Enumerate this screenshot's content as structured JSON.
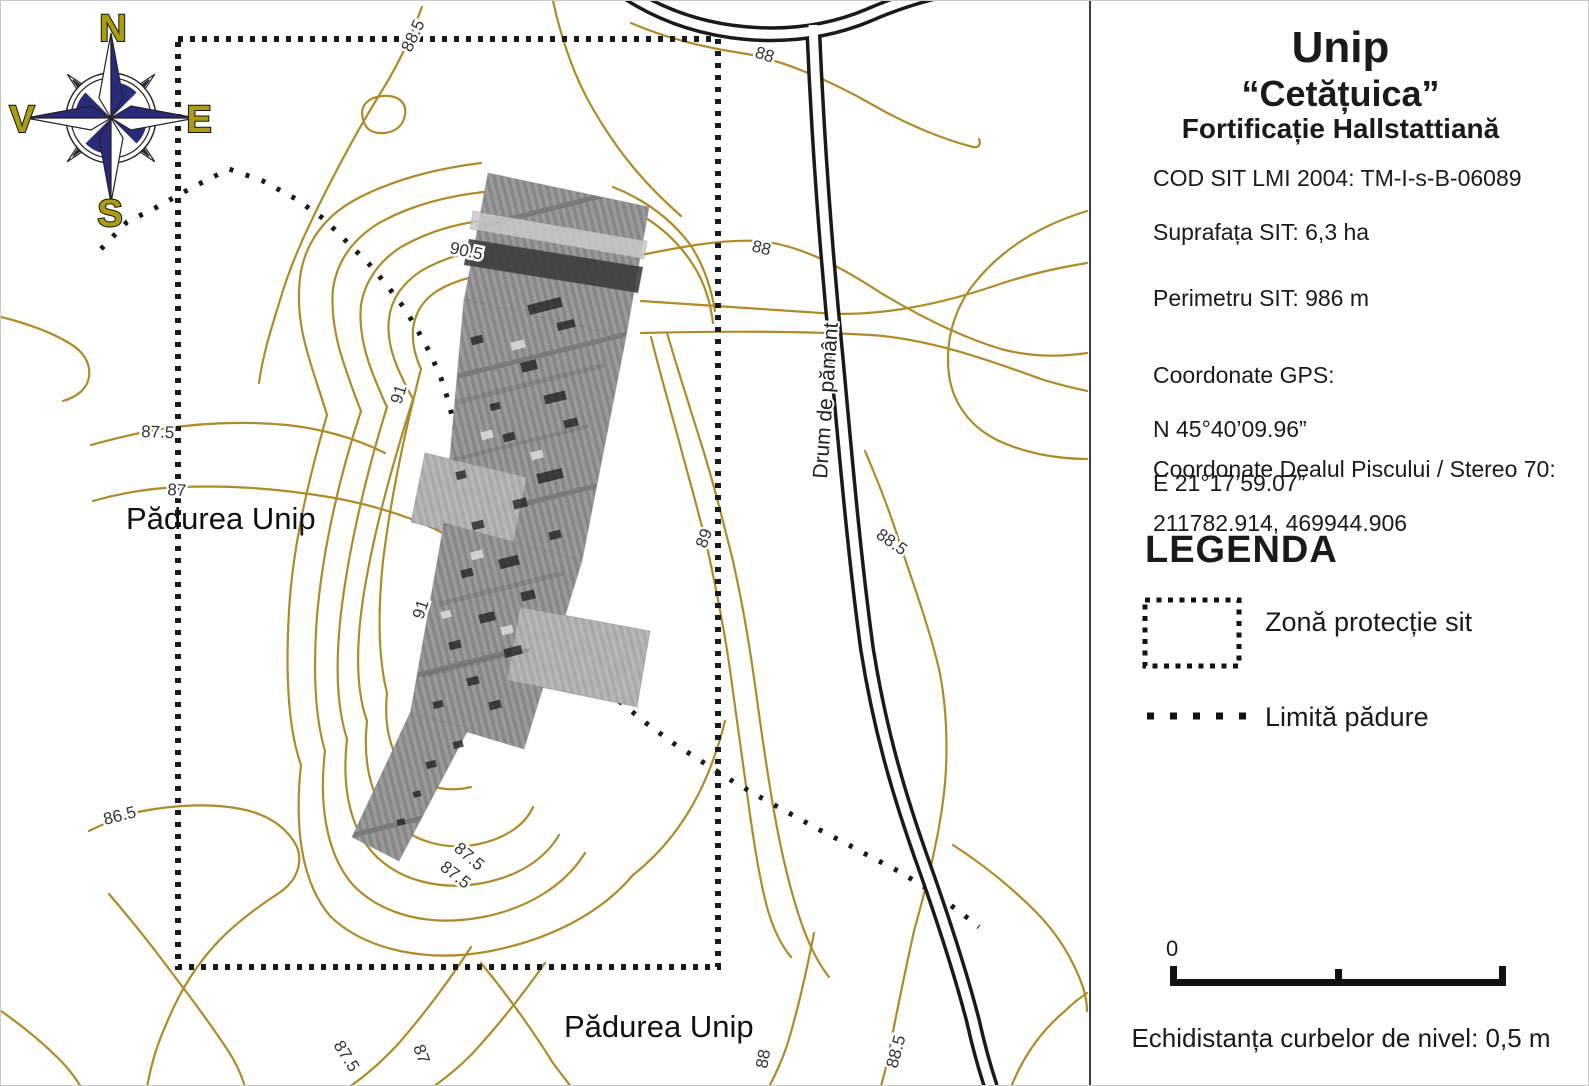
{
  "panel": {
    "title": "Unip",
    "subtitle": "“Cetățuica”",
    "subtitle2": "Fortificație Hallstattiană",
    "cod_sit": "COD SIT LMI 2004: TM-I-s-B-06089",
    "suprafata": "Suprafața SIT:  6,3 ha",
    "perimetru": "Perimetru SIT:  986 m",
    "gps_heading": "Coordonate GPS:",
    "gps_n": "N 45°40’09.96”",
    "gps_e": "E 21°17’59.07”",
    "stereo_heading": "Coordonate Dealul Piscului / Stereo 70:",
    "stereo_values": "211782.914, 469944.906",
    "legend_title": "LEGENDA",
    "legend_items": [
      {
        "symbol": "dotted-rectangle",
        "label": "Zonă protecție sit"
      },
      {
        "symbol": "dotted-line",
        "label": "Limită pădure"
      }
    ],
    "scale": {
      "start": "0",
      "end": "100 m"
    },
    "note": "Echidistanța curbelor de nivel: 0,5 m"
  },
  "map": {
    "compass": {
      "n": "N",
      "e": "E",
      "s": "S",
      "w": "V"
    },
    "place_labels": [
      "Pădurea Unip",
      "Pădurea Unip"
    ],
    "road_label": "Drum de pământ",
    "contour_labels": [
      "88.5",
      "88",
      "88",
      "90.5",
      "91",
      "91",
      "87.5",
      "87",
      "86.5",
      "87.5",
      "87.5",
      "89",
      "88.5",
      "87.5",
      "87",
      "88",
      "88.5"
    ],
    "colors": {
      "contour": "#AD8B28",
      "road": "#1a1a1a",
      "compass_navy": "#2a2a7c",
      "compass_letter": "#ab9c10",
      "survey_gray": "#999999"
    }
  }
}
